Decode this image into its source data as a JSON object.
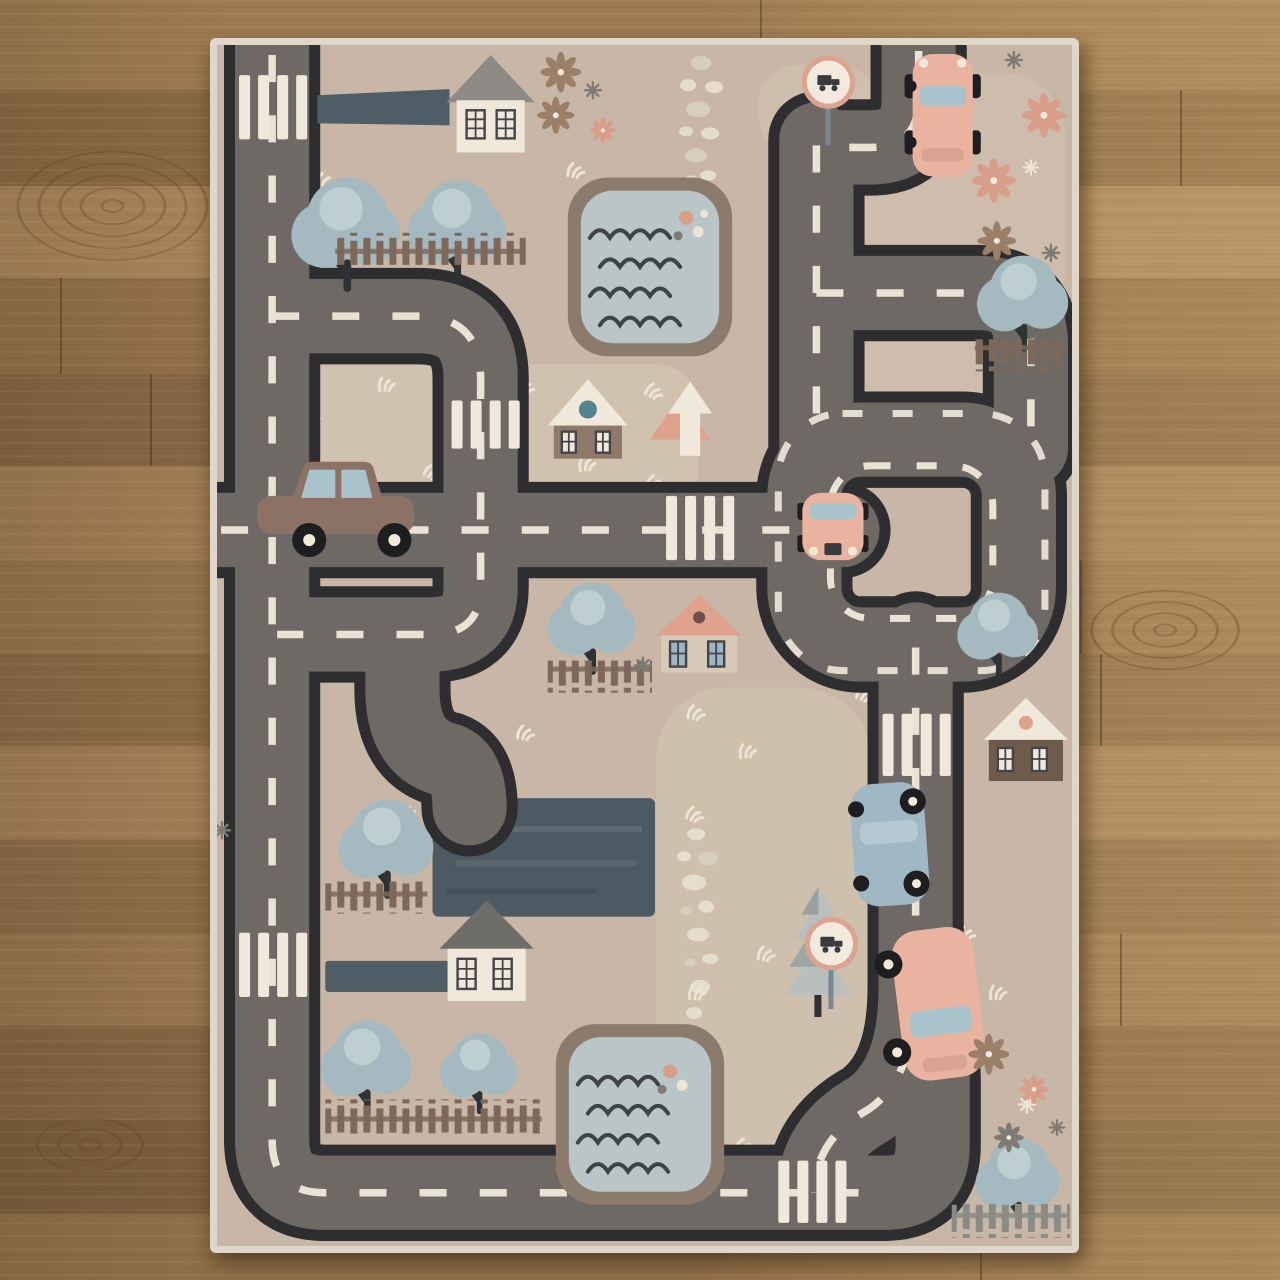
{
  "scene": {
    "description": "Top-down product photo of a children's road-map play rug lying on a wooden plank floor",
    "rug_label": "kids road play rug",
    "floor_label": "wooden plank floor",
    "road_network_label": "gray toy roads with white dashed lane markings and a roundabout loop",
    "counts": {
      "houses": 5,
      "cars": 5,
      "ponds": 2,
      "trees": 9,
      "crosswalks": 6,
      "traffic_signs": 2,
      "fences": 6,
      "parking_lots": 1
    }
  },
  "palette": {
    "rug_bg": "#c8b7a6",
    "rug_binding": "#ded7ca",
    "rug_light": "#d7c9b6",
    "road_fill": "#6e6964",
    "road_edge": "#2e2d2f",
    "road_dash": "#f0e9db",
    "driveway": "#4e5d66",
    "parking": "#4e5a63",
    "pond_edge": "#8b7b6c",
    "pond_water": "#b9c5c7",
    "wave": "#3e4347",
    "tree_fill": "#a4bac0",
    "tree_light": "#c5d6d7",
    "tree_trunk": "#2e3234",
    "fence_brown": "#7d685a",
    "fence_gray": "#8b8b86",
    "house_white": "#efe8db",
    "roof_gray": "#8e8b86",
    "roof_dark": "#6f6d69",
    "roof_salmon": "#dfa28c",
    "body_taupe": "#8d7a6a",
    "body_brown": "#6d5b4c",
    "window_blue": "#9cb6c4",
    "win_frame": "#45454a",
    "teal_dot": "#54858e",
    "car_brown": "#8c7264",
    "car_pink": "#e9b3a0",
    "car_blue": "#9fb8c4",
    "glass": "#a9c3cd",
    "wheel_dark": "#1e1e20",
    "hub_white": "#f1ead9",
    "sign_ring": "#dba390",
    "sign_face": "#f2eade",
    "sign_glyph": "#3a3a3c",
    "pole": "#7a8793",
    "flower_salmon": "#d99e8a",
    "flower_brown": "#9b7f69",
    "flower_gray": "#7e7a74",
    "flower_white": "#ece4d4",
    "grass_white": "#ece4d4",
    "pebble": "#e7dfcf",
    "pine": "#b9bfbd",
    "pine_shade": "#7a8280",
    "wood_knot": "#5f3e1e",
    "wood_rows": [
      "#9d7b51",
      "#8a6a45",
      "#a8855b",
      "#93714b",
      "#876745",
      "#a07d55",
      "#96754e",
      "#8b6b47",
      "#a37f58",
      "#8e6d49",
      "#997750",
      "#876644",
      "#7d5f3f",
      "#92714b"
    ]
  }
}
